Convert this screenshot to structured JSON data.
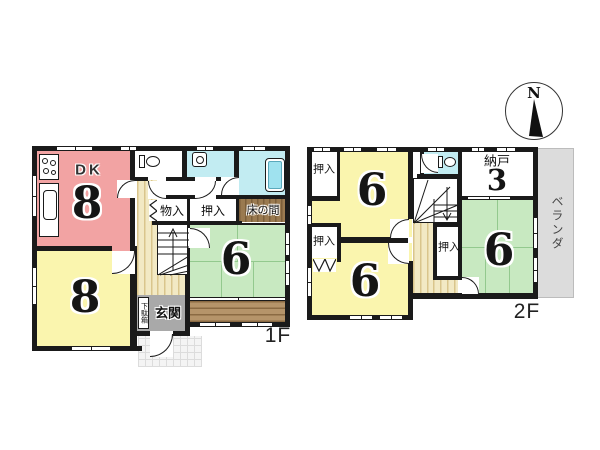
{
  "compass": {
    "north": "N"
  },
  "floor1": {
    "label": "1F",
    "dk_label": "DK",
    "dk_size": "8",
    "room_sw_size": "8",
    "tatami_size": "6",
    "mono_ire": "物入",
    "oshiire": "押入",
    "tokonoma": "床の間",
    "genkan": "玄関",
    "getabako": "下駄箱"
  },
  "floor2": {
    "label": "2F",
    "room_n_size": "6",
    "room_s_size": "6",
    "tatami_size": "6",
    "nando_label": "納戸",
    "nando_size": "3",
    "oshiire_nw": "押入",
    "oshiire_w": "押入",
    "oshiire_e": "押入",
    "veranda": "ベランダ"
  },
  "colors": {
    "wall": "#1a1a1a",
    "dk_pink": "#f2a3a3",
    "room_yellow": "#faf5ae",
    "tatami_green": "#c8e9c1",
    "water_cyan": "#c2ecf2",
    "tub_cyan": "#9fe2ef",
    "hall_beige": "#f2e9c4",
    "engawa_brown": "#b5946a",
    "tokonoma_brown": "#9a7a50",
    "genkan_gray": "#a9a9a9",
    "veranda_gray": "#dcdcdc"
  },
  "icons": [
    "compass-icon",
    "toilet-icon",
    "sink-icon",
    "bathtub-icon",
    "stove-icon",
    "kitchen-sink-icon",
    "stairs-up-icon",
    "stairs-down-icon"
  ]
}
